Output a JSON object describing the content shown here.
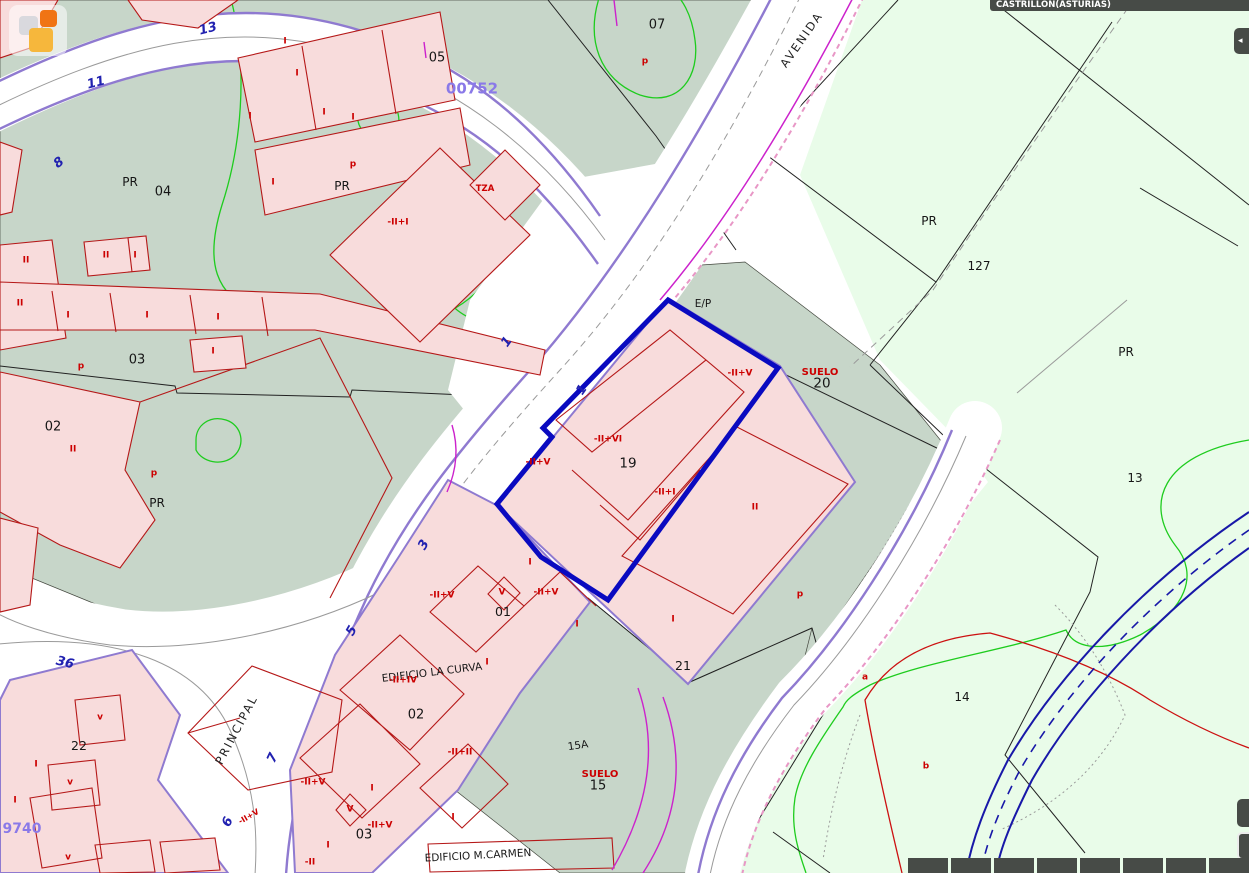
{
  "header": {
    "municipality": "CASTRILLON(ASTURIAS)"
  },
  "colors": {
    "teal": "#c7d6c9",
    "rustic": "#e9fce9",
    "parcel_pink": "#f8dcdc",
    "building_red": "#b51818",
    "boundary_black": "#222222",
    "road_white": "#ffffff",
    "purple_edge": "#8f7ad0",
    "magenta": "#cc22cc",
    "pink_dash": "#e897c6",
    "contour_green": "#1ecc1e",
    "highlight_blue": "#0a0ac0",
    "stream_blue": "#1818a8",
    "label_red": "#cc0000",
    "label_blue": "#2121b0",
    "label_purple": "#8a79e8",
    "chrome_dark": "#474b47",
    "logo_orange": "#f07414",
    "logo_amber": "#f6b73c"
  },
  "controls": {
    "buttons": [
      {
        "id": "panel-toggle",
        "glyph": "◂"
      },
      {
        "id": "tool-upper",
        "glyph": ""
      },
      {
        "id": "tool-lower",
        "glyph": ""
      }
    ],
    "scale_bar_segments": 8
  },
  "map": {
    "highlighted_parcel": "19",
    "street_names": [
      "PRINCIPAL",
      "AVENIDA"
    ],
    "building_names": [
      "EDIFICIO LA CURVA",
      "EDIFICIO M.CARMEN"
    ],
    "labels": [
      {
        "t": "05",
        "x": 437,
        "y": 58,
        "c": "k"
      },
      {
        "t": "07",
        "x": 657,
        "y": 25,
        "c": "k"
      },
      {
        "t": "PR",
        "x": 130,
        "y": 182,
        "c": "k",
        "fs": 12
      },
      {
        "t": "04",
        "x": 163,
        "y": 192,
        "c": "k"
      },
      {
        "t": "PR",
        "x": 342,
        "y": 186,
        "c": "k",
        "fs": 12
      },
      {
        "t": "03",
        "x": 137,
        "y": 360,
        "c": "k"
      },
      {
        "t": "02",
        "x": 53,
        "y": 427,
        "c": "k"
      },
      {
        "t": "PR",
        "x": 157,
        "y": 503,
        "c": "k",
        "fs": 12
      },
      {
        "t": "E/P",
        "x": 703,
        "y": 304,
        "c": "k",
        "fs": 10.5
      },
      {
        "t": "19",
        "x": 628,
        "y": 464,
        "c": "k",
        "fs": 13.5
      },
      {
        "t": "20",
        "x": 822,
        "y": 384,
        "c": "k",
        "fs": 13.5
      },
      {
        "t": "01",
        "x": 503,
        "y": 612,
        "c": "k",
        "fs": 12.5
      },
      {
        "t": "21",
        "x": 683,
        "y": 666,
        "c": "k",
        "fs": 12.5
      },
      {
        "t": "22",
        "x": 79,
        "y": 746,
        "c": "k",
        "fs": 12.5
      },
      {
        "t": "02",
        "x": 416,
        "y": 715,
        "c": "k"
      },
      {
        "t": "03",
        "x": 364,
        "y": 835,
        "c": "k"
      },
      {
        "t": "15A",
        "x": 578,
        "y": 746,
        "c": "k",
        "fs": 10.5,
        "r": -8
      },
      {
        "t": "15",
        "x": 598,
        "y": 786,
        "c": "k"
      },
      {
        "t": "127",
        "x": 979,
        "y": 266,
        "c": "k",
        "fs": 12
      },
      {
        "t": "PR",
        "x": 929,
        "y": 221,
        "c": "k",
        "fs": 12
      },
      {
        "t": "PR",
        "x": 1126,
        "y": 352,
        "c": "k",
        "fs": 12
      },
      {
        "t": "13",
        "x": 1135,
        "y": 478,
        "c": "k",
        "fs": 12
      },
      {
        "t": "14",
        "x": 962,
        "y": 697,
        "c": "k",
        "fs": 12
      },
      {
        "t": "EDIFICIO LA CURVA",
        "x": 432,
        "y": 673,
        "c": "k",
        "fs": 10.5,
        "r": -7
      },
      {
        "t": "EDIFICIO M.CARMEN",
        "x": 478,
        "y": 856,
        "c": "k",
        "fs": 10.5,
        "r": -3
      },
      {
        "t": "p",
        "x": 645,
        "y": 62,
        "c": "r"
      },
      {
        "t": "p",
        "x": 353,
        "y": 165,
        "c": "r"
      },
      {
        "t": "TZA",
        "x": 485,
        "y": 189,
        "c": "r",
        "fs": 8.5
      },
      {
        "t": "-II+I",
        "x": 398,
        "y": 223,
        "c": "r"
      },
      {
        "t": "I",
        "x": 285,
        "y": 42,
        "c": "r"
      },
      {
        "t": "I",
        "x": 297,
        "y": 74,
        "c": "r"
      },
      {
        "t": "I",
        "x": 250,
        "y": 117,
        "c": "r"
      },
      {
        "t": "I",
        "x": 324,
        "y": 113,
        "c": "r"
      },
      {
        "t": "I",
        "x": 353,
        "y": 118,
        "c": "r"
      },
      {
        "t": "I",
        "x": 273,
        "y": 183,
        "c": "r"
      },
      {
        "t": "II",
        "x": 106,
        "y": 256,
        "c": "r"
      },
      {
        "t": "I",
        "x": 135,
        "y": 256,
        "c": "r"
      },
      {
        "t": "II",
        "x": 26,
        "y": 261,
        "c": "r"
      },
      {
        "t": "II",
        "x": 20,
        "y": 304,
        "c": "r"
      },
      {
        "t": "I",
        "x": 68,
        "y": 316,
        "c": "r"
      },
      {
        "t": "I",
        "x": 147,
        "y": 316,
        "c": "r"
      },
      {
        "t": "I",
        "x": 218,
        "y": 318,
        "c": "r"
      },
      {
        "t": "I",
        "x": 213,
        "y": 352,
        "c": "r"
      },
      {
        "t": "p",
        "x": 81,
        "y": 367,
        "c": "r"
      },
      {
        "t": "II",
        "x": 73,
        "y": 450,
        "c": "r"
      },
      {
        "t": "p",
        "x": 154,
        "y": 474,
        "c": "r"
      },
      {
        "t": "-II+V",
        "x": 740,
        "y": 374,
        "c": "r"
      },
      {
        "t": "SUELO",
        "x": 820,
        "y": 373,
        "c": "r",
        "fs": 10
      },
      {
        "t": "-II+VI",
        "x": 608,
        "y": 440,
        "c": "r"
      },
      {
        "t": "-II+V",
        "x": 538,
        "y": 463,
        "c": "r"
      },
      {
        "t": "-II+I",
        "x": 665,
        "y": 493,
        "c": "r"
      },
      {
        "t": "II",
        "x": 755,
        "y": 508,
        "c": "r"
      },
      {
        "t": "p",
        "x": 800,
        "y": 595,
        "c": "r"
      },
      {
        "t": "I",
        "x": 673,
        "y": 620,
        "c": "r"
      },
      {
        "t": "-II+V",
        "x": 442,
        "y": 596,
        "c": "r"
      },
      {
        "t": "V",
        "x": 502,
        "y": 593,
        "c": "r"
      },
      {
        "t": "-II+V",
        "x": 546,
        "y": 593,
        "c": "r"
      },
      {
        "t": "I",
        "x": 530,
        "y": 563,
        "c": "r"
      },
      {
        "t": "I",
        "x": 577,
        "y": 625,
        "c": "r"
      },
      {
        "t": "I",
        "x": 487,
        "y": 663,
        "c": "r"
      },
      {
        "t": "-II+IV",
        "x": 403,
        "y": 681,
        "c": "r"
      },
      {
        "t": "-II+II",
        "x": 460,
        "y": 753,
        "c": "r"
      },
      {
        "t": "SUELO",
        "x": 600,
        "y": 775,
        "c": "r",
        "fs": 10
      },
      {
        "t": "v",
        "x": 100,
        "y": 718,
        "c": "r"
      },
      {
        "t": "I",
        "x": 36,
        "y": 765,
        "c": "r"
      },
      {
        "t": "v",
        "x": 70,
        "y": 783,
        "c": "r"
      },
      {
        "t": "I",
        "x": 15,
        "y": 801,
        "c": "r"
      },
      {
        "t": "v",
        "x": 68,
        "y": 858,
        "c": "r"
      },
      {
        "t": "-II+V",
        "x": 313,
        "y": 783,
        "c": "r"
      },
      {
        "t": "I",
        "x": 372,
        "y": 789,
        "c": "r"
      },
      {
        "t": "V",
        "x": 350,
        "y": 810,
        "c": "r"
      },
      {
        "t": "-II+V",
        "x": 380,
        "y": 826,
        "c": "r"
      },
      {
        "t": "I",
        "x": 328,
        "y": 846,
        "c": "r"
      },
      {
        "t": "-II",
        "x": 310,
        "y": 863,
        "c": "r"
      },
      {
        "t": "I",
        "x": 453,
        "y": 818,
        "c": "r"
      },
      {
        "t": "-II+V",
        "x": 249,
        "y": 817,
        "c": "r",
        "fs": 8,
        "r": -30
      },
      {
        "t": "a",
        "x": 865,
        "y": 678,
        "c": "r"
      },
      {
        "t": "b",
        "x": 926,
        "y": 767,
        "c": "r"
      },
      {
        "t": "13",
        "x": 208,
        "y": 29,
        "c": "b",
        "r": -14
      },
      {
        "t": "11",
        "x": 96,
        "y": 83,
        "c": "b",
        "r": -14
      },
      {
        "t": "8",
        "x": 59,
        "y": 163,
        "c": "b",
        "r": -38
      },
      {
        "t": "1",
        "x": 507,
        "y": 342,
        "c": "b",
        "r": -55
      },
      {
        "t": "1",
        "x": 582,
        "y": 390,
        "c": "b",
        "r": -55
      },
      {
        "t": "3",
        "x": 424,
        "y": 545,
        "c": "b",
        "r": -60
      },
      {
        "t": "5",
        "x": 352,
        "y": 631,
        "c": "b",
        "r": -60
      },
      {
        "t": "7",
        "x": 273,
        "y": 758,
        "c": "b",
        "r": -65
      },
      {
        "t": "6",
        "x": 228,
        "y": 822,
        "c": "b",
        "r": -65
      },
      {
        "t": "36",
        "x": 65,
        "y": 663,
        "c": "b",
        "r": 14
      },
      {
        "t": "00752",
        "x": 472,
        "y": 89,
        "c": "pu"
      },
      {
        "t": "9740",
        "x": 22,
        "y": 829,
        "c": "pu",
        "fs": 14
      },
      {
        "t": "PRINCIPAL",
        "x": 237,
        "y": 730,
        "c": "s",
        "r": -62
      },
      {
        "t": "AVENIDA",
        "x": 802,
        "y": 40,
        "c": "s",
        "r": -55
      }
    ]
  }
}
